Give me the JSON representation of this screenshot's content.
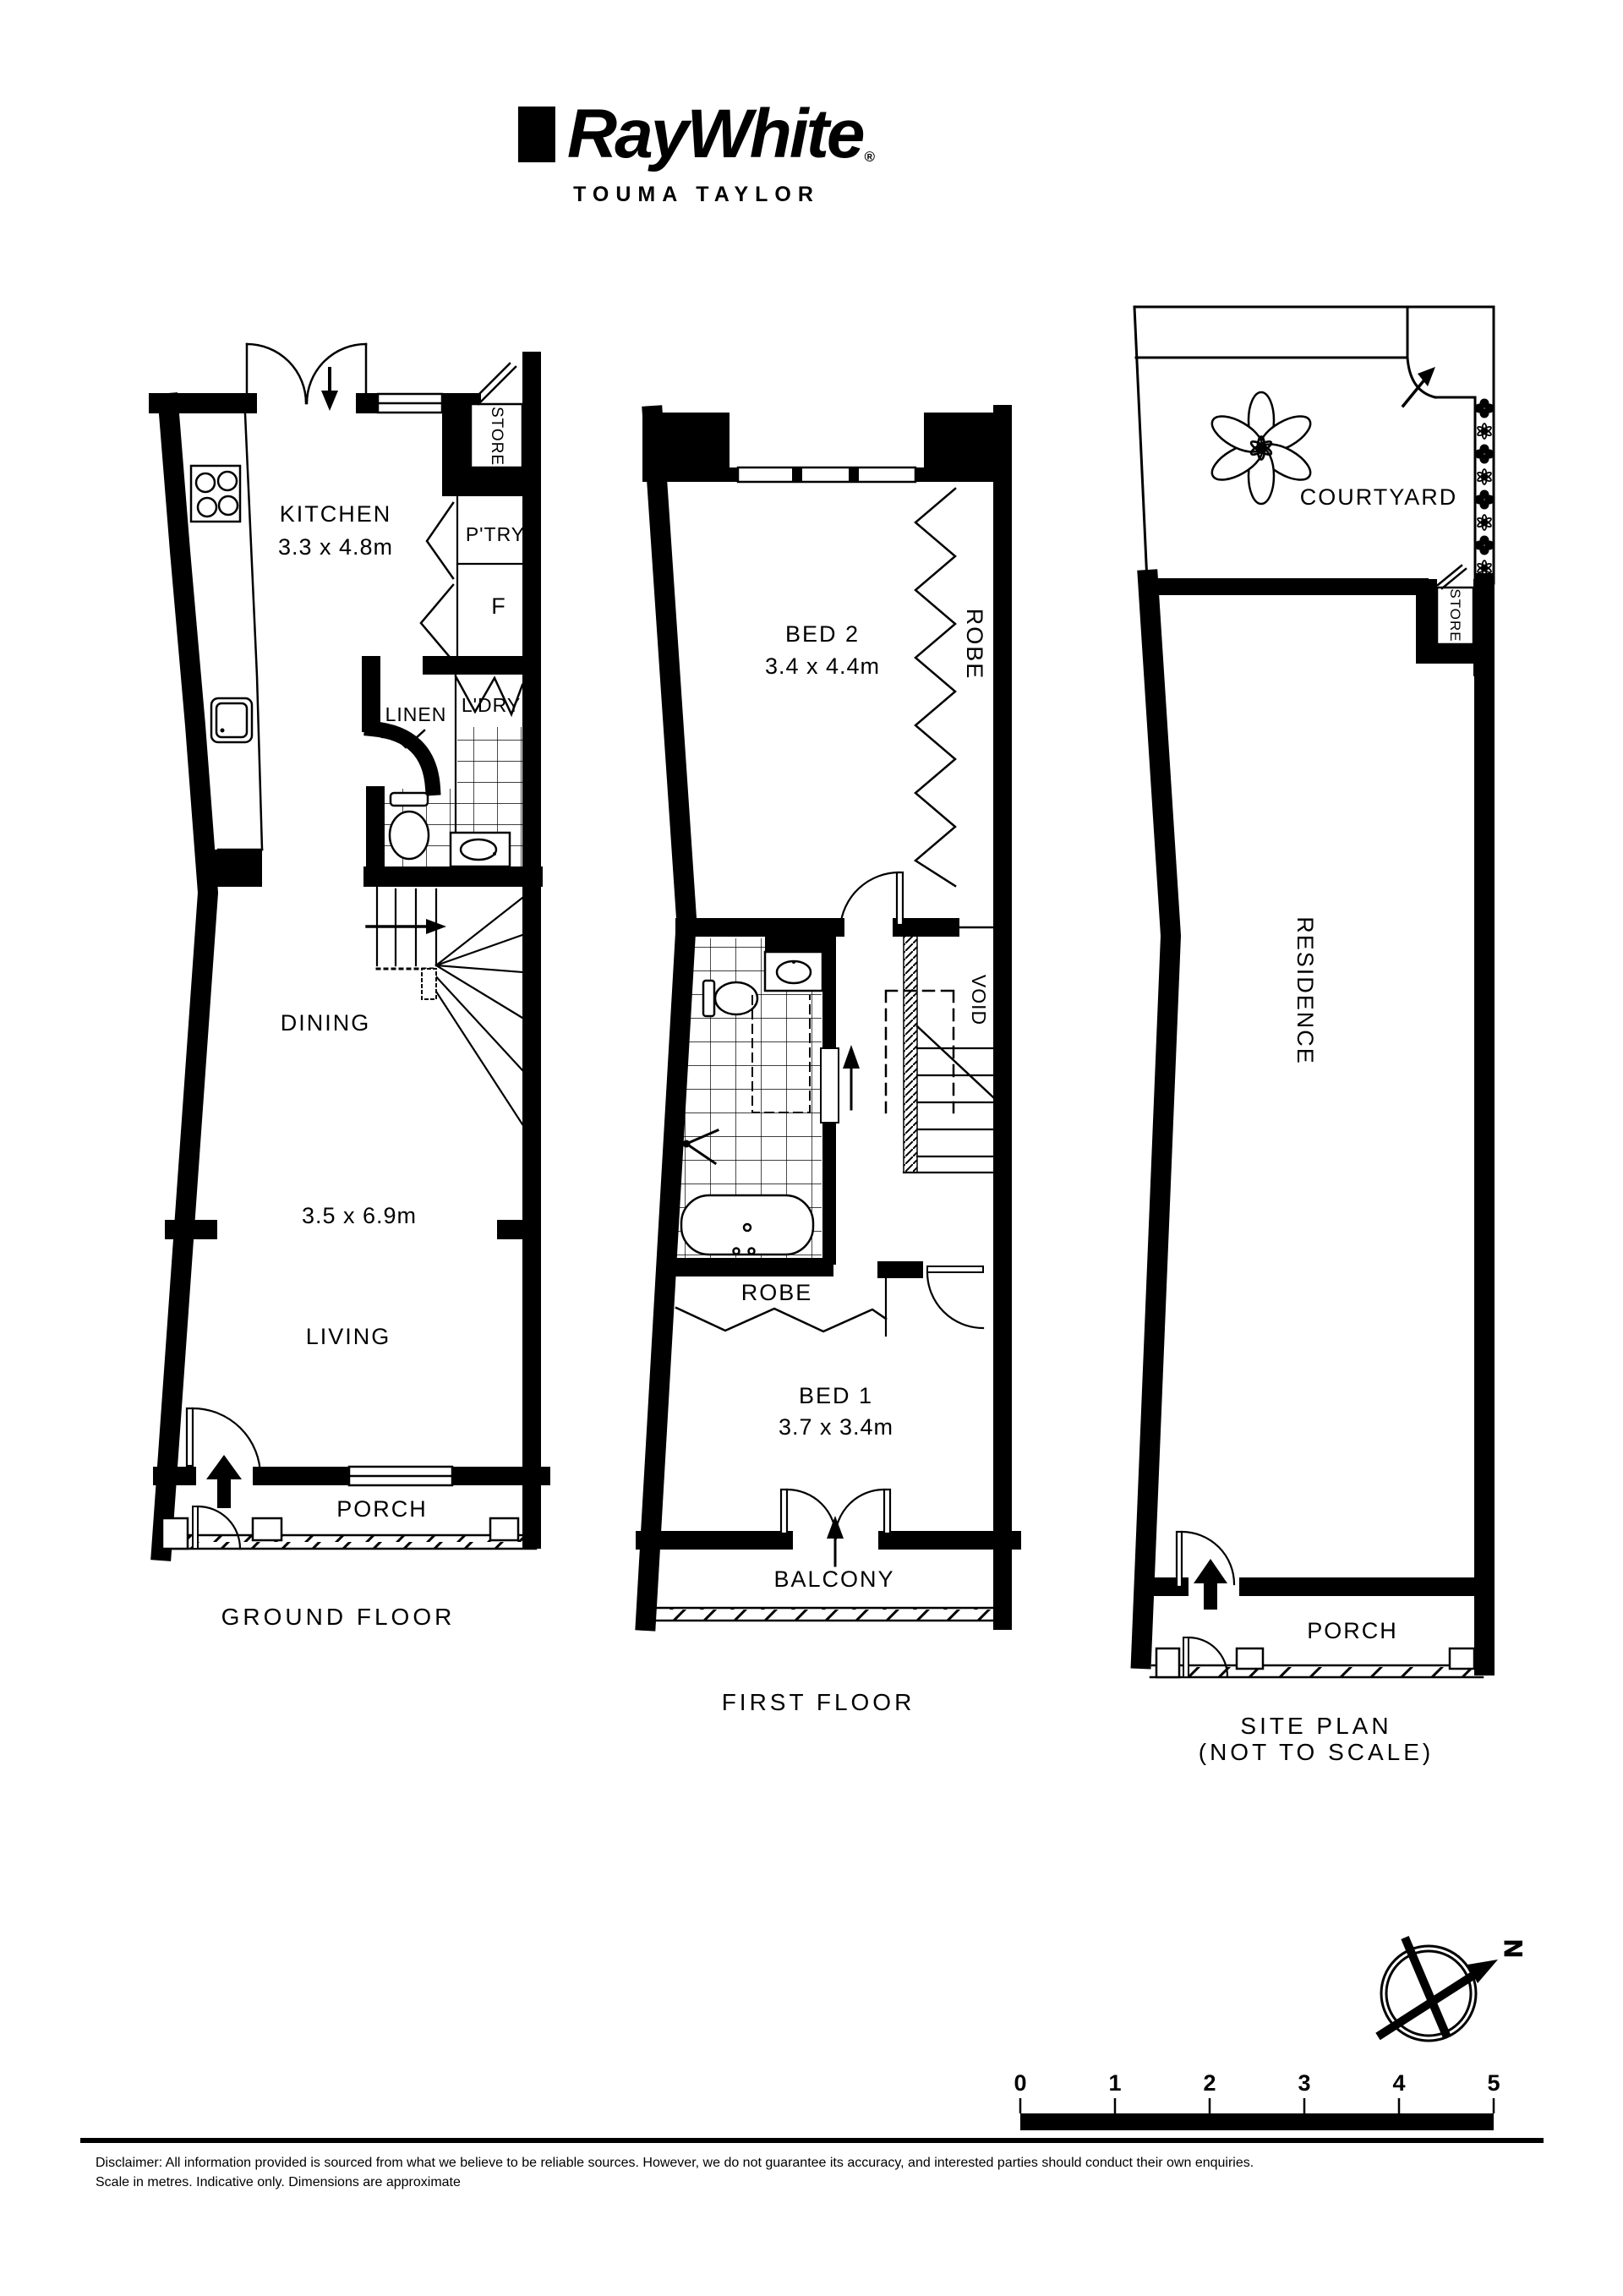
{
  "header": {
    "brand": "RayWhite",
    "brand_registered": "®",
    "office": "TOUMA TAYLOR"
  },
  "plans": {
    "ground": {
      "title": "GROUND FLOOR",
      "kitchen": "KITCHEN",
      "kitchen_dim": "3.3 x 4.8m",
      "store": "STORE",
      "pantry": "P'TRY",
      "fridge": "F",
      "linen": "LINEN",
      "laundry": "L'DRY",
      "dining": "DINING",
      "living_dim": "3.5 x 6.9m",
      "living": "LIVING",
      "porch": "PORCH"
    },
    "first": {
      "title": "FIRST FLOOR",
      "bed2": "BED 2",
      "bed2_dim": "3.4 x 4.4m",
      "robe2": "ROBE",
      "void": "VOID",
      "robe1": "ROBE",
      "bed1": "BED 1",
      "bed1_dim": "3.7 x 3.4m",
      "balcony": "BALCONY"
    },
    "site": {
      "title": "SITE PLAN",
      "title2": "(NOT TO SCALE)",
      "courtyard": "COURTYARD",
      "store": "STORE",
      "residence": "RESIDENCE",
      "porch": "PORCH"
    }
  },
  "compass": {
    "north": "N"
  },
  "scale": {
    "ticks": [
      "0",
      "1",
      "2",
      "3",
      "4",
      "5"
    ]
  },
  "footer": {
    "line1": "Disclaimer: All information provided is sourced from what we believe to be reliable sources. However, we do not guarantee  its accuracy, and interested parties should conduct their own enquiries.",
    "line2": "Scale in metres. Indicative only. Dimensions are approximate"
  },
  "colors": {
    "ink": "#000000",
    "paper": "#ffffff"
  }
}
